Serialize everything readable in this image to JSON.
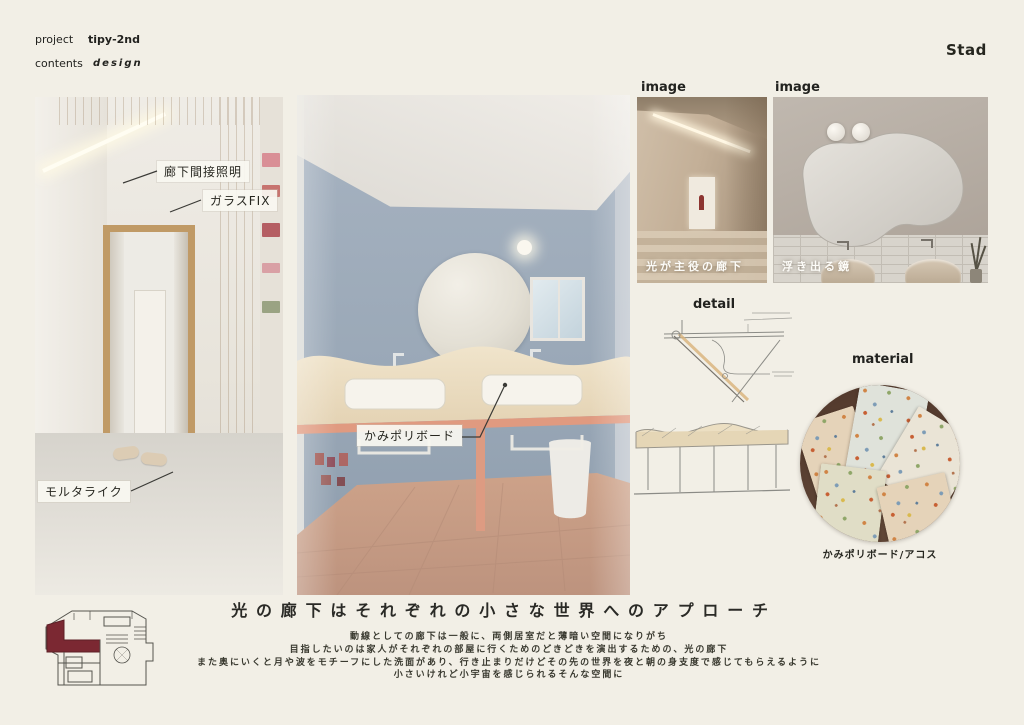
{
  "board": {
    "bg_color": "#f2efe6",
    "accent_maroon": "#7b2832",
    "accent_salmon": "#e09a80",
    "wall_blue": "#9aa9b9"
  },
  "header": {
    "project_label": "project",
    "project_value": "tipy-2nd",
    "contents_label": "contents",
    "contents_value": "design",
    "brand": "Stad"
  },
  "left_image": {
    "annotations": [
      {
        "label": "廊下間接照明"
      },
      {
        "label": "ガラスFIX"
      },
      {
        "label": "モルタライク"
      }
    ]
  },
  "center_image": {
    "annotation": "かみポリボード"
  },
  "reference_images": [
    {
      "heading": "image",
      "caption": "光が主役の廊下"
    },
    {
      "heading": "image",
      "caption": "浮き出る鏡"
    }
  ],
  "detail_section": {
    "heading": "detail"
  },
  "material_section": {
    "heading": "material",
    "caption": "かみポリボード/アコス"
  },
  "statement": {
    "title": "光の廊下はそれぞれの小さな世界へのアプローチ",
    "lines": [
      "動線としての廊下は一般に、両側居室だと薄暗い空間になりがち",
      "目指したいのは家人がそれぞれの部屋に行くためのどきどきを演出するための、光の廊下",
      "また奥にいくと月や波をモチーフにした洗面があり、行き止まりだけどその先の世界を夜と朝の身支度で感じてもらえるように",
      "小さいけれど小宇宙を感じられるそんな空間に"
    ]
  }
}
